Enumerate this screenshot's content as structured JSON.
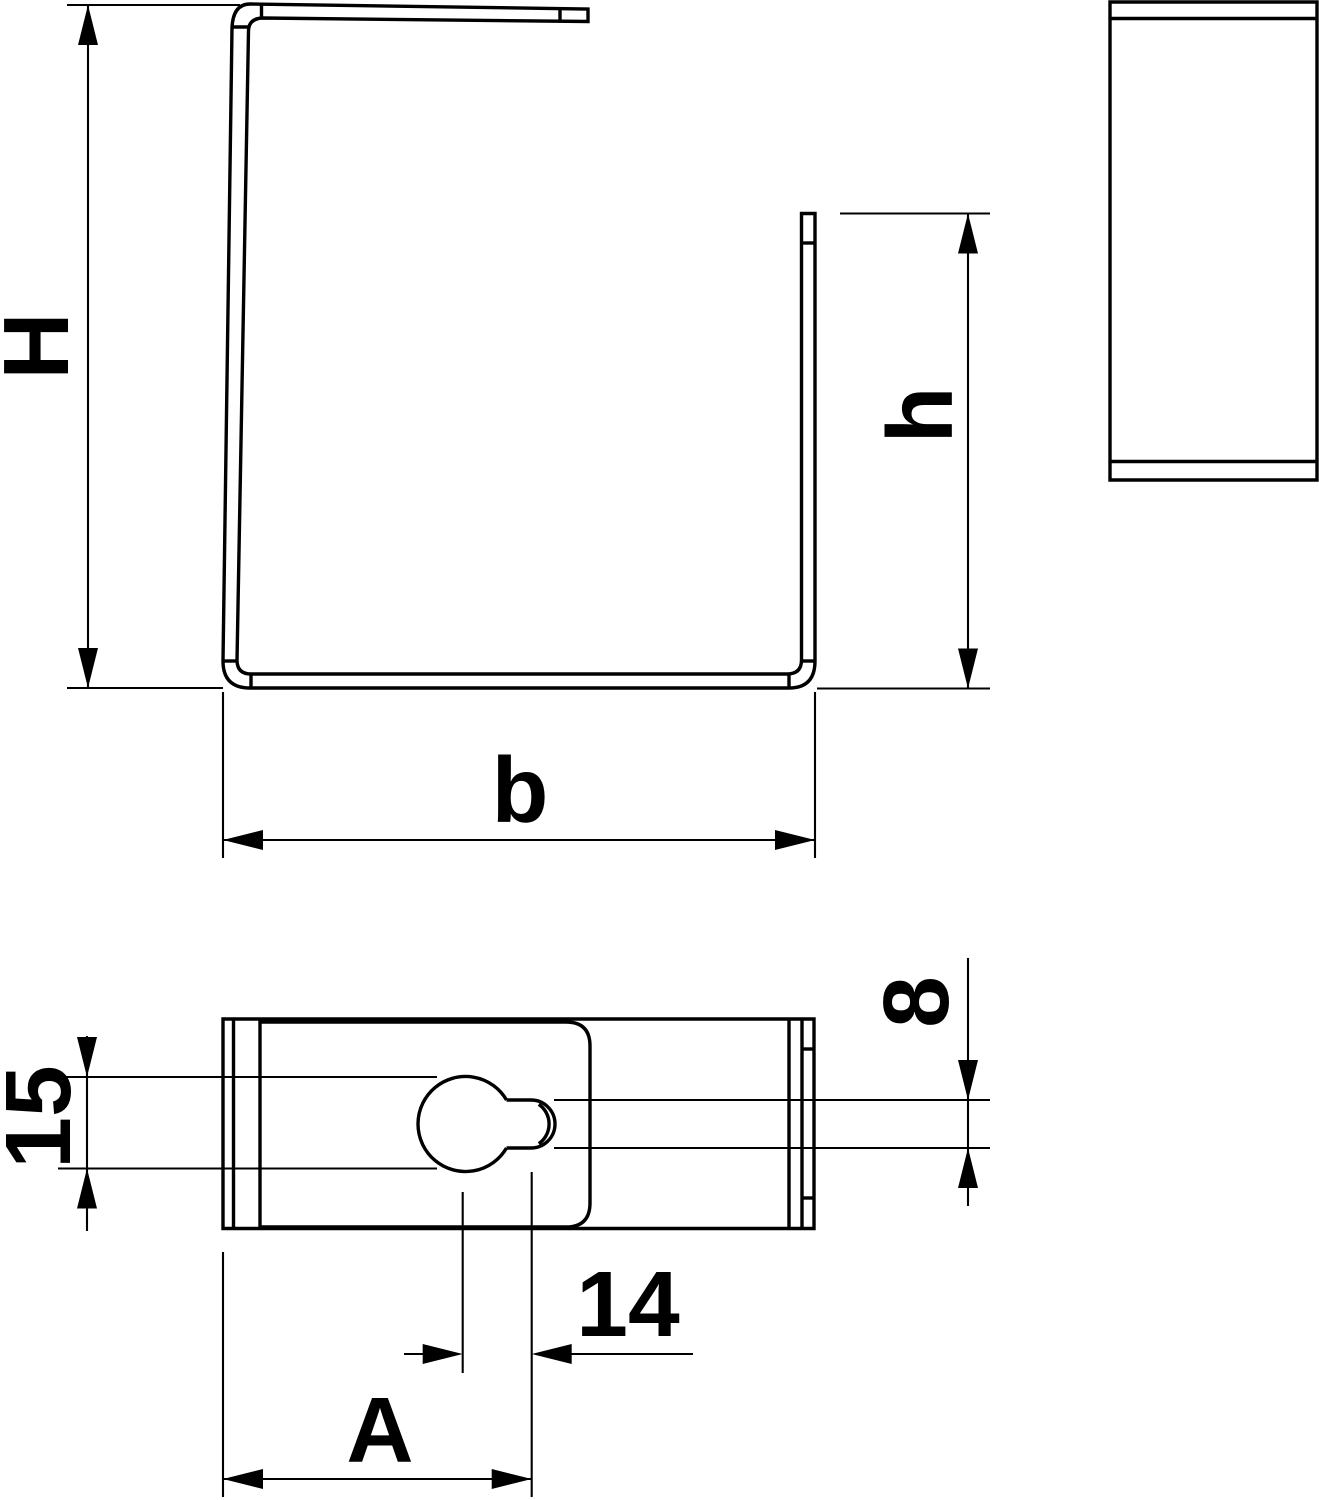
{
  "drawing": {
    "background_color": "#ffffff",
    "line_color": "#000000",
    "labels": {
      "overall_height": "H",
      "leg_height": "h",
      "base_width": "b",
      "slot_diameter": "15",
      "slot_tab_height": "8",
      "hole_center_offset": "14",
      "hole_position_width": "A"
    }
  }
}
